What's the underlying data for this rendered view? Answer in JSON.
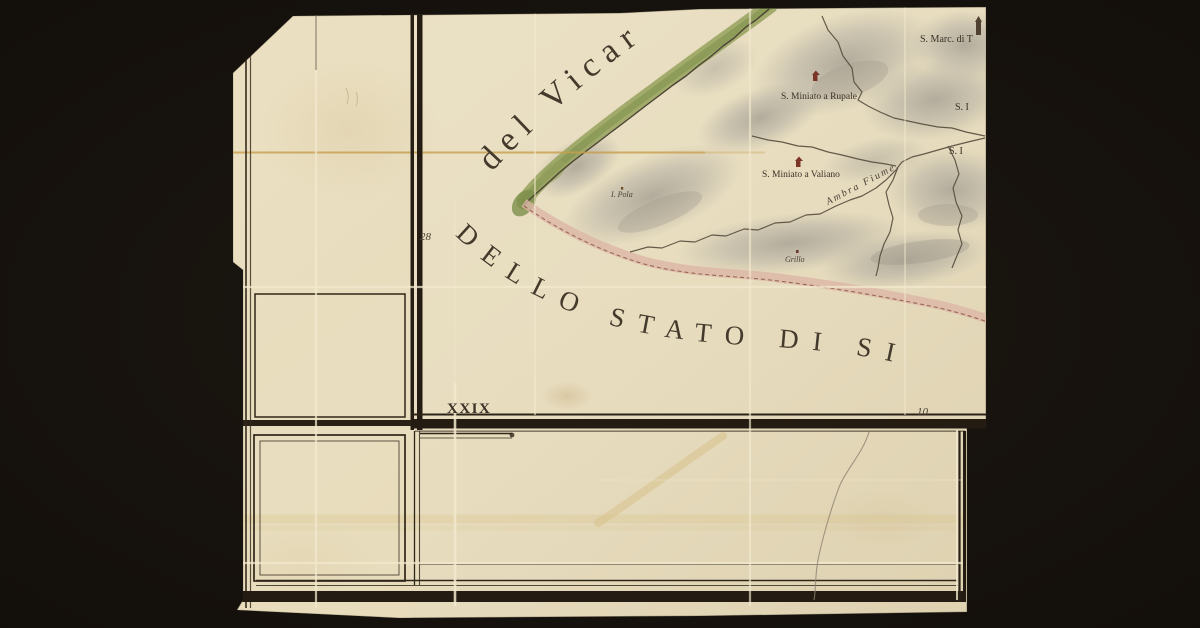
{
  "map": {
    "sheet_label": "XXIX",
    "coordinate_labels": {
      "left_margin": "28",
      "bottom_margin": "10"
    },
    "territory_labels": {
      "vicariato": "del Vicar",
      "stato": "DELLO STATO DI SI"
    },
    "river_label": "Ambra Fiume.",
    "places": [
      {
        "name": "S. Marc. di T"
      },
      {
        "name": "S. Miniato a Rupale"
      },
      {
        "name": "S. Miniato a Valiano"
      },
      {
        "name": "S. I"
      },
      {
        "name": "S. I"
      },
      {
        "name": "I. Pola"
      },
      {
        "name": "Grillo"
      }
    ],
    "colors": {
      "background": "#18130f",
      "paper": "#e8dec2",
      "ink": "#2c241a",
      "river_green": "#93a05c",
      "boundary_pink": "#dcb6a6",
      "hill_gray": "#b3aea1",
      "road_yellow": "#d4ba7e"
    }
  }
}
